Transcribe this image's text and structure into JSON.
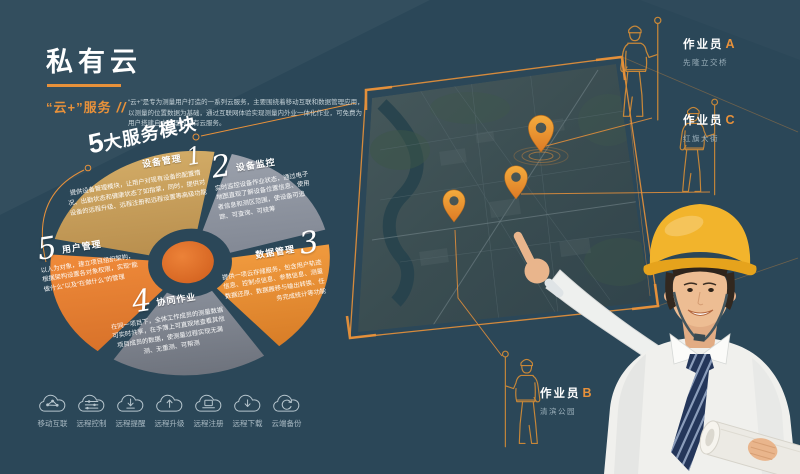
{
  "header": {
    "title": "私有云",
    "subtitle": "“云+”服务",
    "slashes": "//",
    "description": "“云+”是专为测量用户打造的一系列云服务，主要围绕着移动互联和数据管理应用，以测量的位置数据为基础，通过互联网体验实现测量内外业一体化作业，可免费为用户搭建自主管理的私有云服务。"
  },
  "modules_header": {
    "big": "5",
    "rest": "大服务模块"
  },
  "modules": [
    {
      "num": "1",
      "name": "设备管理",
      "desc": "提供设备管理模块，让用户对现有设备的配置情况、出勤状态和健康状态了如指掌，同时，提供对设备的远程升级、远程注册和远程设置等高级功能"
    },
    {
      "num": "2",
      "name": "设备监控",
      "desc": "实时监控设备作业状态，通过电子地图直观了解设备位置信息、使用者信息和测区范围，使设备可追踪、可查询、可统筹"
    },
    {
      "num": "3",
      "name": "数据管理",
      "desc": "提供一项云存储服务，包含用户轨迹信息、控制点信息、参数信息、测量数据还原、数据搬移与输出转换、任务完成统计等功能"
    },
    {
      "num": "4",
      "name": "协同作业",
      "desc": "在同一项目下，全体工作成员的测量数据可实时共享，在手簿上可直观地查看其他项目成员的数据，使测量过程实现无漏测、无重测、可帮测"
    },
    {
      "num": "5",
      "name": "用户管理",
      "desc": "以人为对象，建立项目组织架构，根据架构设置各对象权限，实现“能做什么”以及“在做什么”的管理"
    }
  ],
  "features": [
    {
      "label": "移动互联",
      "icon": "cloud-mobile-network-icon"
    },
    {
      "label": "远程控制",
      "icon": "cloud-sliders-icon"
    },
    {
      "label": "远程提醒",
      "icon": "cloud-arrow-down-line-icon"
    },
    {
      "label": "远程升级",
      "icon": "cloud-arrow-up-icon"
    },
    {
      "label": "远程注册",
      "icon": "cloud-laptop-icon"
    },
    {
      "label": "远程下载",
      "icon": "cloud-arrow-down-icon"
    },
    {
      "label": "云端备份",
      "icon": "cloud-sync-icon"
    }
  ],
  "workers": [
    {
      "role": "作业员",
      "letter": "A",
      "location": "先隆立交桥"
    },
    {
      "role": "作业员",
      "letter": "C",
      "location": "红旗大街"
    },
    {
      "role": "作业员",
      "letter": "B",
      "location": "清滨公园"
    }
  ],
  "colors": {
    "background": "#2b4758",
    "accent": "#e8913a",
    "sector_device_mgmt": "#c9a25e",
    "sector_device_monitor": "#9097a1",
    "sector_data_mgmt": "#e89138",
    "sector_collab": "#7d838d",
    "sector_user_mgmt": "#e87f35",
    "wheel_center": "#df6f2d",
    "helmet_yellow": "#f2b42c"
  }
}
